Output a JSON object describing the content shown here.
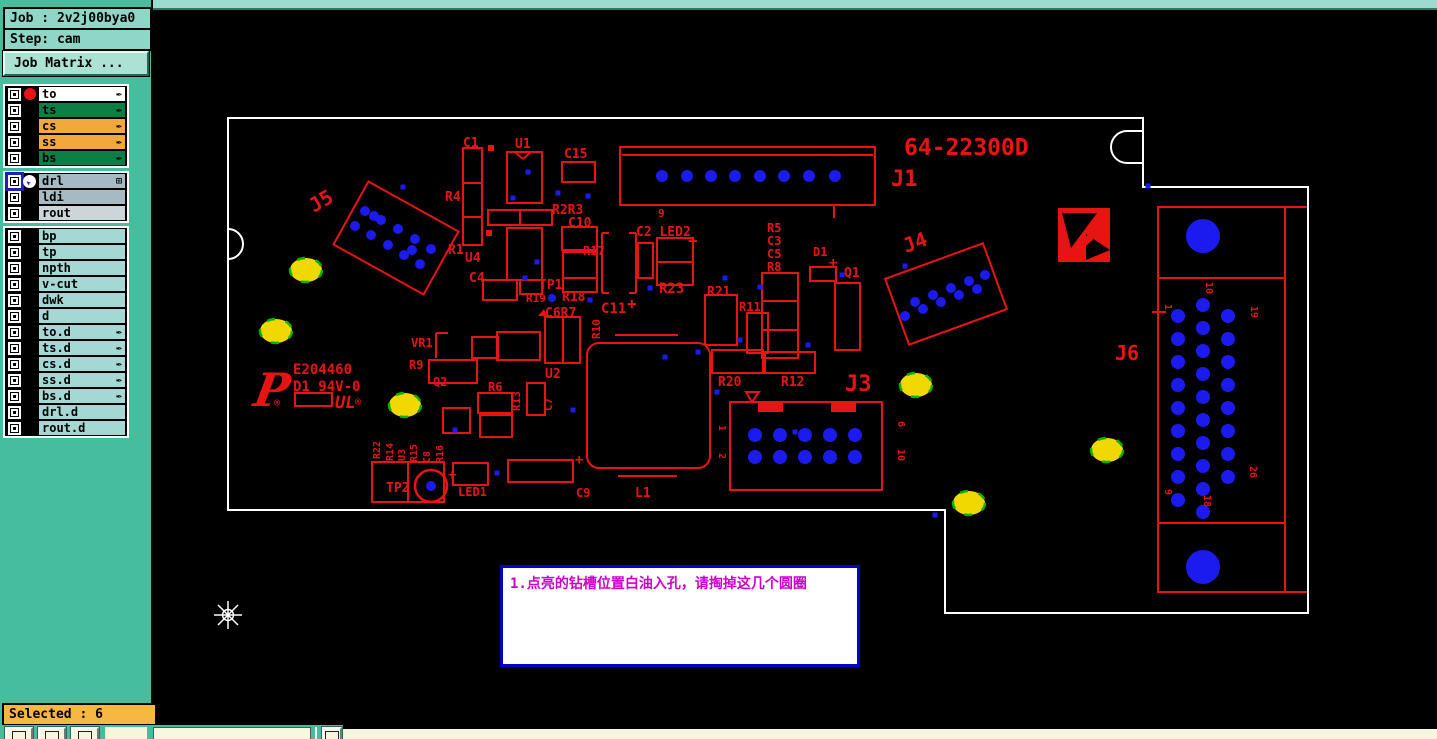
{
  "sidebar": {
    "job_label": "Job : 2v2j00bya0",
    "step_label": "Step: cam",
    "matrix_button": "Job Matrix ...",
    "selected_label": "Selected : 6",
    "layer_groups": [
      {
        "rows": [
          {
            "name": "to",
            "color": "white",
            "dot": true,
            "arrow": true
          },
          {
            "name": "ts",
            "color": "green",
            "arrow": true
          },
          {
            "name": "cs",
            "color": "orange",
            "arrow": true
          },
          {
            "name": "ss",
            "color": "orange",
            "arrow": true
          },
          {
            "name": "bs",
            "color": "green",
            "arrow": true
          }
        ]
      },
      {
        "rows": [
          {
            "name": "drl",
            "color": "gray",
            "selected": true,
            "cursor": true,
            "grid": true
          },
          {
            "name": "ldi",
            "color": "gray"
          },
          {
            "name": "rout",
            "color": "lightgray"
          }
        ]
      },
      {
        "rows": [
          {
            "name": "bp",
            "color": "cyan"
          },
          {
            "name": "tp",
            "color": "cyan"
          },
          {
            "name": "npth",
            "color": "cyan"
          },
          {
            "name": "v-cut",
            "color": "cyan"
          },
          {
            "name": "dwk",
            "color": "cyan"
          },
          {
            "name": "d",
            "color": "cyan"
          },
          {
            "name": "to.d",
            "color": "cyan",
            "arrow": true
          },
          {
            "name": "ts.d",
            "color": "cyan",
            "arrow": true
          },
          {
            "name": "cs.d",
            "color": "cyan",
            "arrow": true
          },
          {
            "name": "ss.d",
            "color": "cyan",
            "arrow": true
          },
          {
            "name": "bs.d",
            "color": "cyan",
            "arrow": true
          },
          {
            "name": "drl.d",
            "color": "cyan"
          },
          {
            "name": "rout.d",
            "color": "cyan"
          }
        ]
      }
    ]
  },
  "note": {
    "text": "1.点亮的钻槽位置白油入孔，请掏掉这几个圆圈"
  },
  "pcb": {
    "colors": {
      "silk": "#e81414",
      "drill": "#1b1bef",
      "highlight": "#f0d800",
      "highlight_edge": "#00b400",
      "outline": "#ffffff",
      "note_text": "#cc00cc",
      "note_border": "#0000cc"
    },
    "p_logo": "P",
    "ul_logo": "UL",
    "reg_mark": "®",
    "outline": "M 228,118 L 1143,118 L 1143,187 L 1308,187 L 1308,613 L 945,613 L 945,510 L 228,510 Z",
    "notches": [
      "M 228,229 A 15 15 0 0 1 228,259",
      "M 1143,131 L 1127,131 A 16 16 0 0 0 1127,163 L 1143,163"
    ],
    "labels": [
      {
        "t": "64-22300D",
        "x": 904,
        "y": 155,
        "s": 23
      },
      {
        "t": "J1",
        "x": 891,
        "y": 186,
        "s": 22
      },
      {
        "t": "J3",
        "x": 845,
        "y": 391,
        "s": 22
      },
      {
        "t": "J6",
        "x": 1115,
        "y": 360,
        "s": 20
      },
      {
        "t": "J5",
        "x": 314,
        "y": 213,
        "s": 20,
        "r": -30
      },
      {
        "t": "J4",
        "x": 906,
        "y": 253,
        "s": 20,
        "r": -20
      },
      {
        "t": "C1",
        "x": 463,
        "y": 147,
        "s": 13
      },
      {
        "t": "U1",
        "x": 515,
        "y": 148,
        "s": 13
      },
      {
        "t": "C15",
        "x": 564,
        "y": 158,
        "s": 13
      },
      {
        "t": "R4",
        "x": 445,
        "y": 201,
        "s": 13
      },
      {
        "t": "R1",
        "x": 448,
        "y": 254,
        "s": 13
      },
      {
        "t": "U4",
        "x": 465,
        "y": 262,
        "s": 13
      },
      {
        "t": "C4",
        "x": 469,
        "y": 282,
        "s": 13
      },
      {
        "t": "R2R3",
        "x": 552,
        "y": 214,
        "s": 13
      },
      {
        "t": "C10",
        "x": 568,
        "y": 227,
        "s": 13
      },
      {
        "t": "R17",
        "x": 583,
        "y": 255,
        "s": 12
      },
      {
        "t": "C2 LED2",
        "x": 636,
        "y": 236,
        "s": 13
      },
      {
        "t": "+",
        "x": 688,
        "y": 246,
        "s": 16
      },
      {
        "t": "9",
        "x": 658,
        "y": 217,
        "s": 11
      },
      {
        "t": "R23",
        "x": 659,
        "y": 293,
        "s": 14
      },
      {
        "t": "R5",
        "x": 767,
        "y": 232,
        "s": 12
      },
      {
        "t": "C3",
        "x": 767,
        "y": 245,
        "s": 12
      },
      {
        "t": "C5",
        "x": 767,
        "y": 258,
        "s": 12
      },
      {
        "t": "R8",
        "x": 767,
        "y": 271,
        "s": 12
      },
      {
        "t": "D1",
        "x": 813,
        "y": 256,
        "s": 12
      },
      {
        "t": "+",
        "x": 829,
        "y": 267,
        "s": 14
      },
      {
        "t": "Q1",
        "x": 844,
        "y": 277,
        "s": 13
      },
      {
        "t": "R21",
        "x": 707,
        "y": 296,
        "s": 13
      },
      {
        "t": "R11",
        "x": 739,
        "y": 311,
        "s": 12
      },
      {
        "t": "R20",
        "x": 718,
        "y": 386,
        "s": 13
      },
      {
        "t": "R12",
        "x": 781,
        "y": 386,
        "s": 13
      },
      {
        "t": "TP1",
        "x": 539,
        "y": 289,
        "s": 13
      },
      {
        "t": "R19",
        "x": 526,
        "y": 302,
        "s": 11
      },
      {
        "t": "R18",
        "x": 562,
        "y": 301,
        "s": 13
      },
      {
        "t": "C6R7",
        "x": 545,
        "y": 317,
        "s": 13
      },
      {
        "t": "C11",
        "x": 601,
        "y": 313,
        "s": 14
      },
      {
        "t": "+",
        "x": 627,
        "y": 309,
        "s": 16
      },
      {
        "t": "R10",
        "x": 600,
        "y": 339,
        "s": 11,
        "r": -90
      },
      {
        "t": "U2",
        "x": 545,
        "y": 378,
        "s": 13
      },
      {
        "t": "C7",
        "x": 552,
        "y": 411,
        "s": 11,
        "r": -90
      },
      {
        "t": "R13",
        "x": 520,
        "y": 411,
        "s": 11,
        "r": -90
      },
      {
        "t": "R6",
        "x": 488,
        "y": 391,
        "s": 12
      },
      {
        "t": "Q2",
        "x": 433,
        "y": 386,
        "s": 12
      },
      {
        "t": "VR1",
        "x": 411,
        "y": 347,
        "s": 12
      },
      {
        "t": "R9",
        "x": 409,
        "y": 369,
        "s": 12
      },
      {
        "t": "E204460",
        "x": 293,
        "y": 374,
        "s": 14
      },
      {
        "t": "D1 94V-0",
        "x": 293,
        "y": 391,
        "s": 14
      },
      {
        "t": "R22",
        "x": 380,
        "y": 459,
        "s": 10,
        "r": -90
      },
      {
        "t": "R14",
        "x": 393,
        "y": 461,
        "s": 10,
        "r": -90
      },
      {
        "t": "U3",
        "x": 405,
        "y": 461,
        "s": 10,
        "r": -90
      },
      {
        "t": "R15",
        "x": 417,
        "y": 462,
        "s": 10,
        "r": -90
      },
      {
        "t": "C8",
        "x": 430,
        "y": 463,
        "s": 10,
        "r": -90
      },
      {
        "t": "R16",
        "x": 443,
        "y": 463,
        "s": 10,
        "r": -90
      },
      {
        "t": "TP2",
        "x": 386,
        "y": 492,
        "s": 13
      },
      {
        "t": "+",
        "x": 448,
        "y": 479,
        "s": 14
      },
      {
        "t": "LED1",
        "x": 458,
        "y": 496,
        "s": 12
      },
      {
        "t": "C9",
        "x": 576,
        "y": 497,
        "s": 12
      },
      {
        "t": "+",
        "x": 575,
        "y": 464,
        "s": 14
      },
      {
        "t": "L1",
        "x": 635,
        "y": 497,
        "s": 13
      },
      {
        "t": "1",
        "x": 719,
        "y": 425,
        "s": 10,
        "r": 90
      },
      {
        "t": "2",
        "x": 719,
        "y": 453,
        "s": 10,
        "r": 90
      },
      {
        "t": "6",
        "x": 898,
        "y": 421,
        "s": 10,
        "r": 90
      },
      {
        "t": "10",
        "x": 898,
        "y": 449,
        "s": 10,
        "r": 90
      },
      {
        "t": "10",
        "x": 1206,
        "y": 282,
        "s": 10,
        "r": 90
      },
      {
        "t": "1",
        "x": 1165,
        "y": 304,
        "s": 10,
        "r": 90
      },
      {
        "t": "19",
        "x": 1251,
        "y": 306,
        "s": 10,
        "r": 90
      },
      {
        "t": "9",
        "x": 1165,
        "y": 489,
        "s": 10,
        "r": 90
      },
      {
        "t": "18",
        "x": 1204,
        "y": 495,
        "s": 10,
        "r": 90
      },
      {
        "t": "26",
        "x": 1250,
        "y": 466,
        "s": 10,
        "r": 90
      }
    ],
    "rects": [
      [
        620,
        147,
        255,
        58
      ],
      [
        463,
        148,
        19,
        35
      ],
      [
        463,
        183,
        19,
        34
      ],
      [
        463,
        217,
        19,
        28
      ],
      [
        507,
        152,
        35,
        51
      ],
      [
        562,
        162,
        33,
        20
      ],
      [
        488,
        210,
        32,
        15
      ],
      [
        520,
        210,
        32,
        15
      ],
      [
        562,
        227,
        35,
        23
      ],
      [
        563,
        252,
        34,
        26
      ],
      [
        563,
        278,
        34,
        14
      ],
      [
        638,
        243,
        15,
        35
      ],
      [
        657,
        238,
        36,
        24
      ],
      [
        657,
        262,
        36,
        23
      ],
      [
        835,
        283,
        25,
        67
      ],
      [
        762,
        273,
        36,
        28
      ],
      [
        762,
        301,
        36,
        29
      ],
      [
        762,
        330,
        36,
        28
      ],
      [
        705,
        295,
        32,
        50
      ],
      [
        747,
        313,
        21,
        40
      ],
      [
        712,
        350,
        51,
        23
      ],
      [
        765,
        352,
        50,
        21
      ],
      [
        730,
        402,
        152,
        88
      ],
      [
        1158,
        207,
        127,
        385
      ],
      [
        507,
        228,
        35,
        52
      ],
      [
        483,
        280,
        34,
        20
      ],
      [
        520,
        280,
        22,
        14
      ],
      [
        545,
        317,
        18,
        46
      ],
      [
        563,
        317,
        17,
        46
      ],
      [
        497,
        332,
        43,
        28
      ],
      [
        527,
        383,
        18,
        32
      ],
      [
        472,
        337,
        26,
        21
      ],
      [
        478,
        393,
        34,
        20
      ],
      [
        480,
        415,
        32,
        22
      ],
      [
        443,
        408,
        27,
        25
      ],
      [
        429,
        360,
        48,
        23
      ],
      [
        372,
        462,
        36,
        40
      ],
      [
        408,
        462,
        36,
        40
      ],
      [
        453,
        463,
        35,
        22
      ],
      [
        508,
        460,
        65,
        22
      ],
      [
        295,
        393,
        37,
        13
      ],
      [
        810,
        267,
        26,
        14
      ],
      [
        587,
        343,
        123,
        125,
        12
      ]
    ],
    "rotrects": [
      {
        "cx": 396,
        "cy": 238,
        "w": 103,
        "h": 72,
        "rot": 29
      },
      {
        "cx": 946,
        "cy": 294,
        "w": 104,
        "h": 70,
        "rot": -20
      }
    ],
    "frects": [
      [
        758,
        403,
        25,
        9
      ],
      [
        831,
        403,
        25,
        9
      ],
      [
        488,
        145,
        6,
        6
      ],
      [
        486,
        230,
        6,
        6
      ]
    ],
    "tris": [
      "538,316 544,309 547,316"
    ],
    "otris": [
      "746,392 759,392 752,402"
    ],
    "lines": [
      [
        622,
        155,
        873,
        155
      ],
      [
        834,
        205,
        834,
        218
      ],
      [
        602,
        233,
        602,
        293
      ],
      [
        602,
        233,
        609,
        233
      ],
      [
        602,
        293,
        609,
        293
      ],
      [
        636,
        233,
        636,
        293
      ],
      [
        629,
        233,
        636,
        233
      ],
      [
        629,
        293,
        636,
        293
      ],
      [
        1158,
        278,
        1285,
        278
      ],
      [
        1158,
        523,
        1285,
        523
      ],
      [
        1285,
        207,
        1307,
        207
      ],
      [
        1285,
        592,
        1307,
        592
      ],
      [
        1152,
        312,
        1166,
        312
      ],
      [
        615,
        335,
        678,
        335
      ],
      [
        618,
        476,
        677,
        476
      ],
      [
        436,
        333,
        436,
        358
      ],
      [
        436,
        333,
        448,
        333
      ],
      [
        515,
        152,
        523,
        159
      ],
      [
        523,
        159,
        531,
        152
      ]
    ],
    "holes": [
      [
        662,
        176,
        6
      ],
      [
        687,
        176,
        6
      ],
      [
        711,
        176,
        6
      ],
      [
        735,
        176,
        6
      ],
      [
        760,
        176,
        6
      ],
      [
        784,
        176,
        6
      ],
      [
        809,
        176,
        6
      ],
      [
        835,
        176,
        6
      ],
      [
        755,
        435,
        7
      ],
      [
        780,
        435,
        7
      ],
      [
        805,
        435,
        7
      ],
      [
        830,
        435,
        7
      ],
      [
        855,
        435,
        7
      ],
      [
        755,
        457,
        7
      ],
      [
        780,
        457,
        7
      ],
      [
        805,
        457,
        7
      ],
      [
        830,
        457,
        7
      ],
      [
        855,
        457,
        7
      ],
      [
        1178,
        316,
        7
      ],
      [
        1178,
        339,
        7
      ],
      [
        1178,
        362,
        7
      ],
      [
        1178,
        385,
        7
      ],
      [
        1178,
        408,
        7
      ],
      [
        1178,
        431,
        7
      ],
      [
        1178,
        454,
        7
      ],
      [
        1178,
        477,
        7
      ],
      [
        1178,
        500,
        7
      ],
      [
        1203,
        305,
        7
      ],
      [
        1203,
        328,
        7
      ],
      [
        1203,
        351,
        7
      ],
      [
        1203,
        374,
        7
      ],
      [
        1203,
        397,
        7
      ],
      [
        1203,
        420,
        7
      ],
      [
        1203,
        443,
        7
      ],
      [
        1203,
        466,
        7
      ],
      [
        1203,
        489,
        7
      ],
      [
        1203,
        512,
        7
      ],
      [
        1228,
        316,
        7
      ],
      [
        1228,
        339,
        7
      ],
      [
        1228,
        362,
        7
      ],
      [
        1228,
        385,
        7
      ],
      [
        1228,
        408,
        7
      ],
      [
        1228,
        431,
        7
      ],
      [
        1228,
        454,
        7
      ],
      [
        1228,
        477,
        7
      ],
      [
        1203,
        236,
        17
      ],
      [
        1203,
        567,
        17
      ],
      [
        365,
        211,
        5
      ],
      [
        381,
        220,
        5
      ],
      [
        398,
        229,
        5
      ],
      [
        415,
        239,
        5
      ],
      [
        431,
        249,
        5
      ],
      [
        355,
        226,
        5
      ],
      [
        371,
        235,
        5
      ],
      [
        388,
        245,
        5
      ],
      [
        404,
        255,
        5
      ],
      [
        420,
        264,
        5
      ],
      [
        374,
        216,
        5
      ],
      [
        412,
        250,
        5
      ],
      [
        915,
        302,
        5
      ],
      [
        933,
        295,
        5
      ],
      [
        951,
        288,
        5
      ],
      [
        969,
        281,
        5
      ],
      [
        985,
        275,
        5
      ],
      [
        905,
        316,
        5
      ],
      [
        923,
        309,
        5
      ],
      [
        941,
        302,
        5
      ],
      [
        959,
        295,
        5
      ],
      [
        977,
        289,
        5
      ],
      [
        431,
        486,
        5
      ],
      [
        552,
        298,
        4
      ]
    ],
    "vias": [
      [
        403,
        187
      ],
      [
        528,
        172
      ],
      [
        558,
        193
      ],
      [
        588,
        196
      ],
      [
        513,
        198
      ],
      [
        537,
        262
      ],
      [
        525,
        278
      ],
      [
        650,
        288
      ],
      [
        725,
        278
      ],
      [
        590,
        300
      ],
      [
        698,
        352
      ],
      [
        740,
        340
      ],
      [
        760,
        287
      ],
      [
        842,
        275
      ],
      [
        497,
        473
      ],
      [
        573,
        410
      ],
      [
        717,
        392
      ],
      [
        1148,
        186
      ],
      [
        935,
        515
      ],
      [
        808,
        345
      ],
      [
        905,
        266
      ],
      [
        795,
        432
      ],
      [
        665,
        357
      ],
      [
        455,
        430
      ]
    ],
    "highlights": [
      [
        306,
        270
      ],
      [
        276,
        331
      ],
      [
        405,
        405
      ],
      [
        916,
        385
      ],
      [
        969,
        503
      ],
      [
        1107,
        450
      ]
    ],
    "circles": [
      [
        431,
        486,
        16
      ]
    ]
  },
  "bottombar": {
    "input_value": ""
  }
}
